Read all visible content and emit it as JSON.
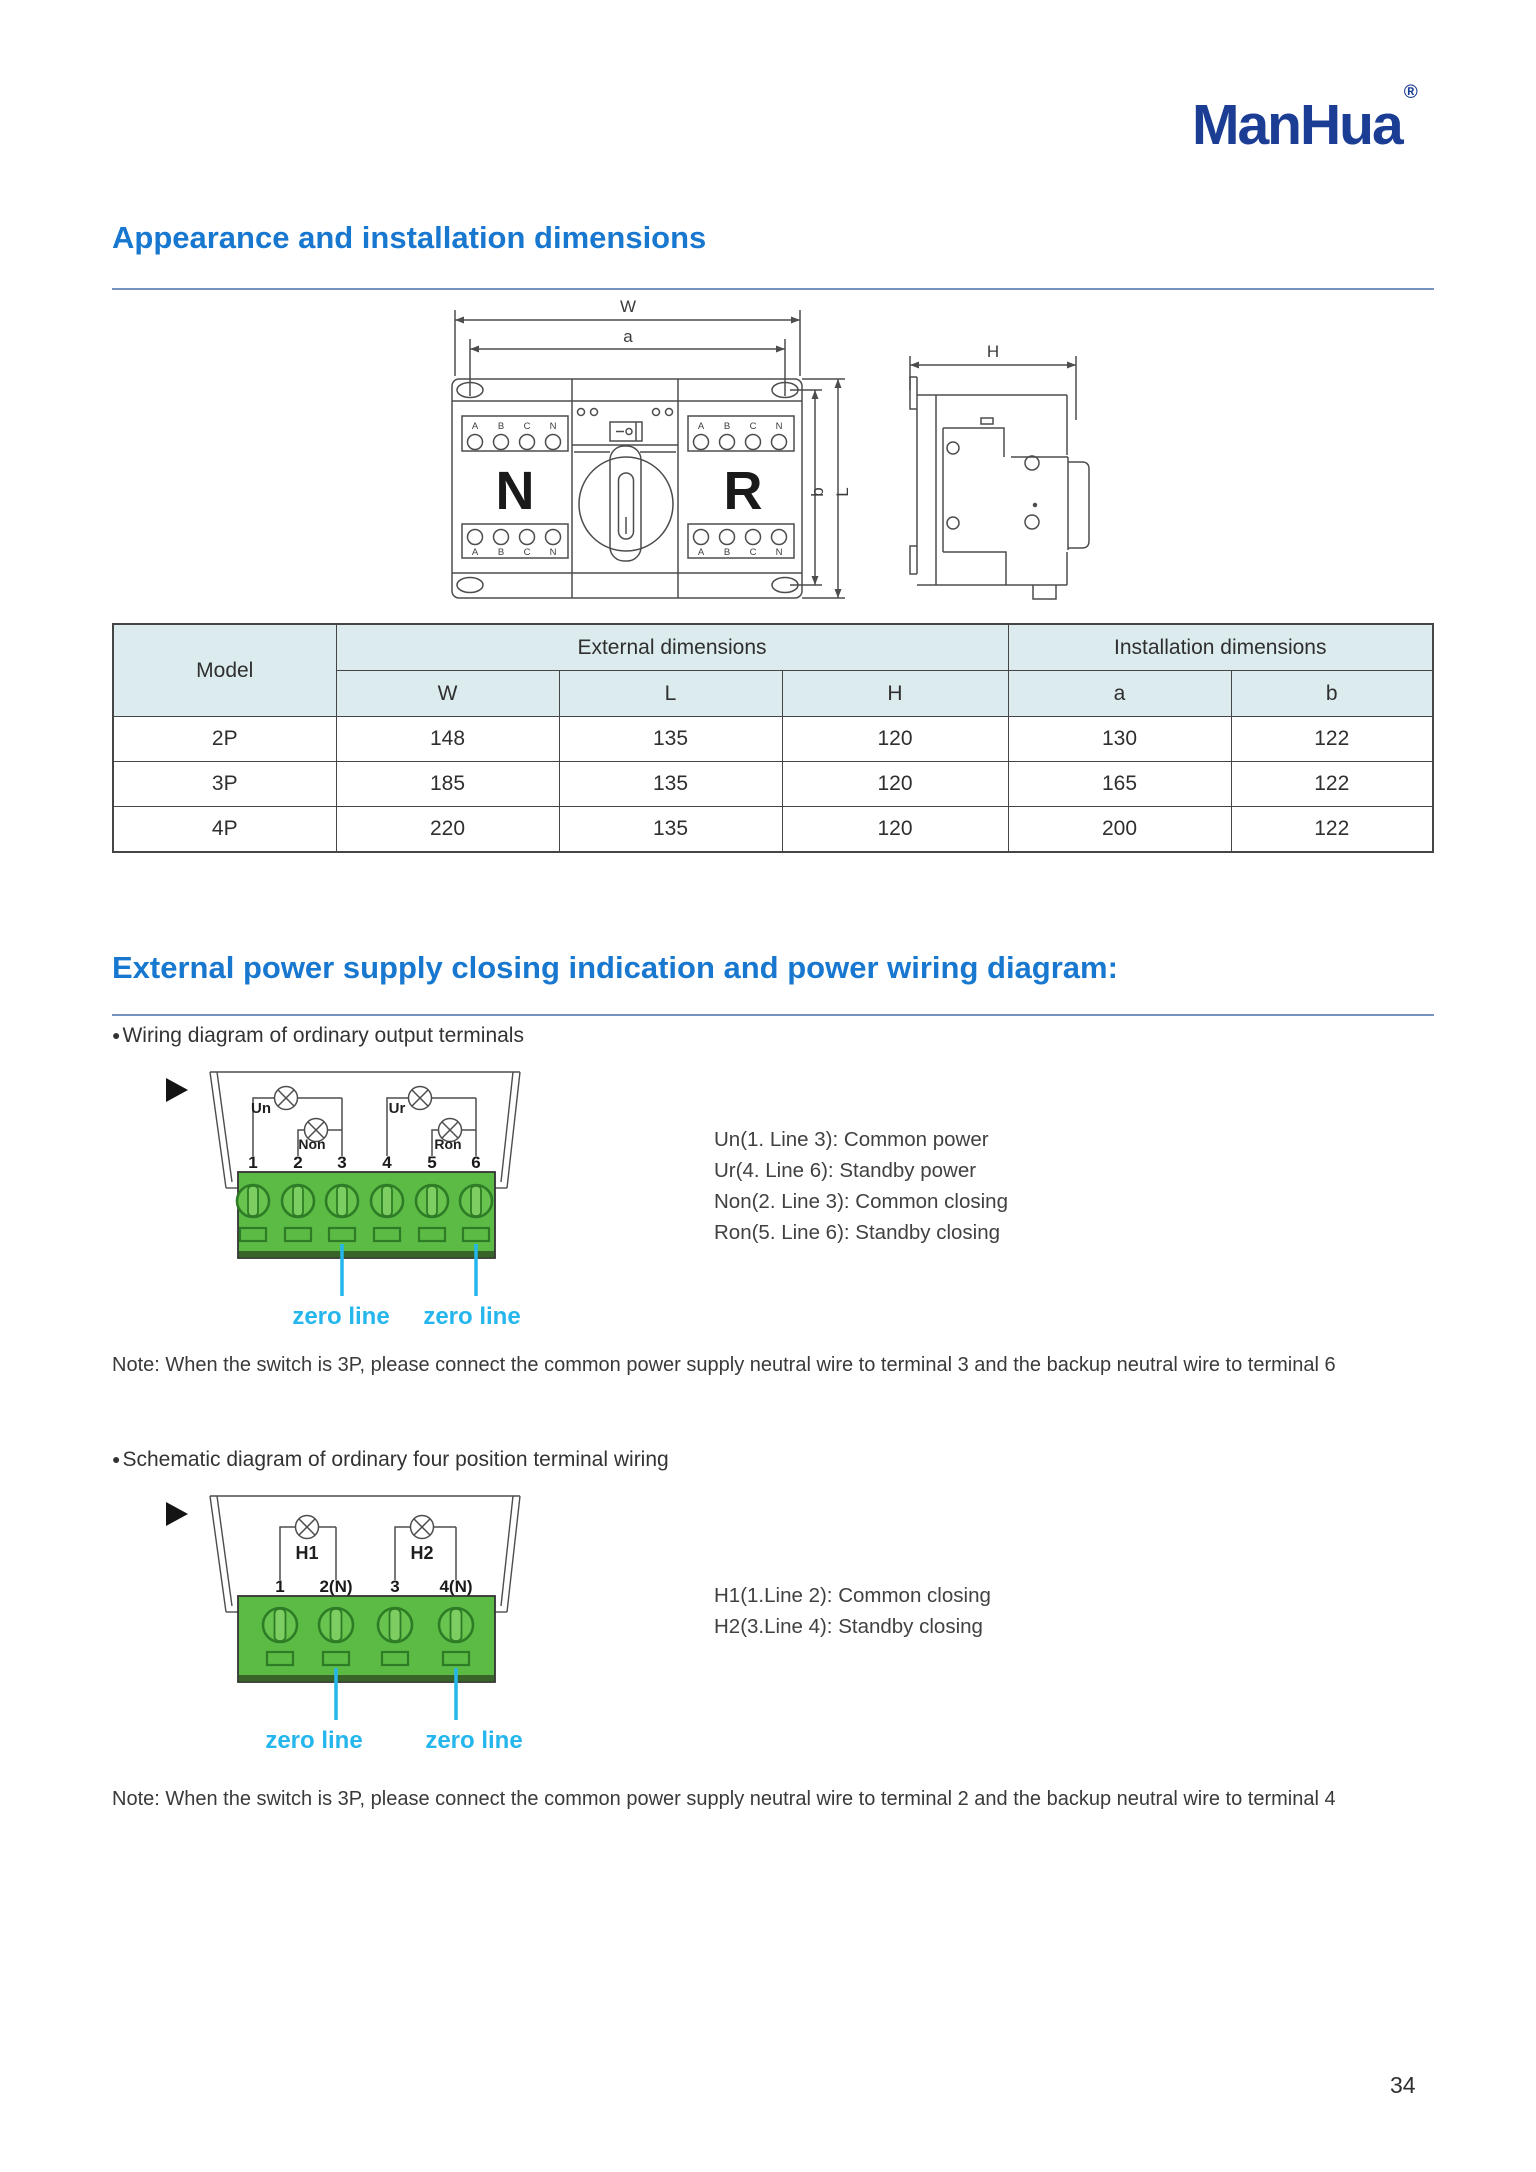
{
  "brand": {
    "name": "ManHua",
    "registered": "®"
  },
  "page": {
    "number": "34"
  },
  "section_dimensions": {
    "heading": "Appearance and installation dimensions",
    "front_view": {
      "dim_w": "W",
      "dim_a": "a",
      "dim_b": "b",
      "dim_l": "L",
      "left_switch": "N",
      "right_switch": "R",
      "phase_labels": [
        "A",
        "B",
        "C",
        "N"
      ]
    },
    "side_view": {
      "dim_h": "H"
    },
    "table": {
      "model_header": "Model",
      "external_header": "External dimensions",
      "installation_header": "Installation dimensions",
      "sub_headers": [
        "W",
        "L",
        "H",
        "a",
        "b"
      ],
      "rows": [
        {
          "model": "2P",
          "w": "148",
          "l": "135",
          "h": "120",
          "a": "130",
          "b": "122"
        },
        {
          "model": "3P",
          "w": "185",
          "l": "135",
          "h": "120",
          "a": "165",
          "b": "122"
        },
        {
          "model": "4P",
          "w": "220",
          "l": "135",
          "h": "120",
          "a": "200",
          "b": "122"
        }
      ]
    }
  },
  "section_wiring": {
    "heading": "External power supply closing indication and power wiring diagram:",
    "block1": {
      "bullet": "Wiring diagram of ordinary output terminals",
      "diagram": {
        "lamps": {
          "un": "Un",
          "non": "Non",
          "ur": "Ur",
          "ron": "Ron"
        },
        "terminals": [
          "1",
          "2",
          "3",
          "4",
          "5",
          "6"
        ],
        "zero_left": "zero line",
        "zero_right": "zero line"
      },
      "legend": [
        "Un(1. Line 3): Common power",
        "Ur(4. Line 6): Standby power",
        "Non(2. Line 3): Common closing",
        "Ron(5. Line 6): Standby closing"
      ],
      "note": "Note: When the switch is 3P, please connect the common power supply neutral wire to terminal 3 and the backup neutral wire to terminal 6"
    },
    "block2": {
      "bullet": "Schematic diagram of ordinary four position terminal wiring",
      "diagram": {
        "lamps": {
          "h1": "H1",
          "h2": "H2"
        },
        "terminals": [
          "1",
          "2(N)",
          "3",
          "4(N)"
        ],
        "zero_left": "zero line",
        "zero_right": "zero line"
      },
      "legend": [
        "H1(1.Line 2): Common closing",
        "H2(3.Line 4): Standby closing"
      ],
      "note": "Note: When the switch is 3P, please connect the common power supply neutral wire to terminal 2 and the backup neutral wire to terminal 4"
    }
  },
  "colors": {
    "heading_blue": "#1878d0",
    "logo_navy": "#1c3d94",
    "zero_line_cyan": "#24b6ec",
    "terminal_green": "#5bbb45",
    "table_header_bg": "#dcebee"
  }
}
